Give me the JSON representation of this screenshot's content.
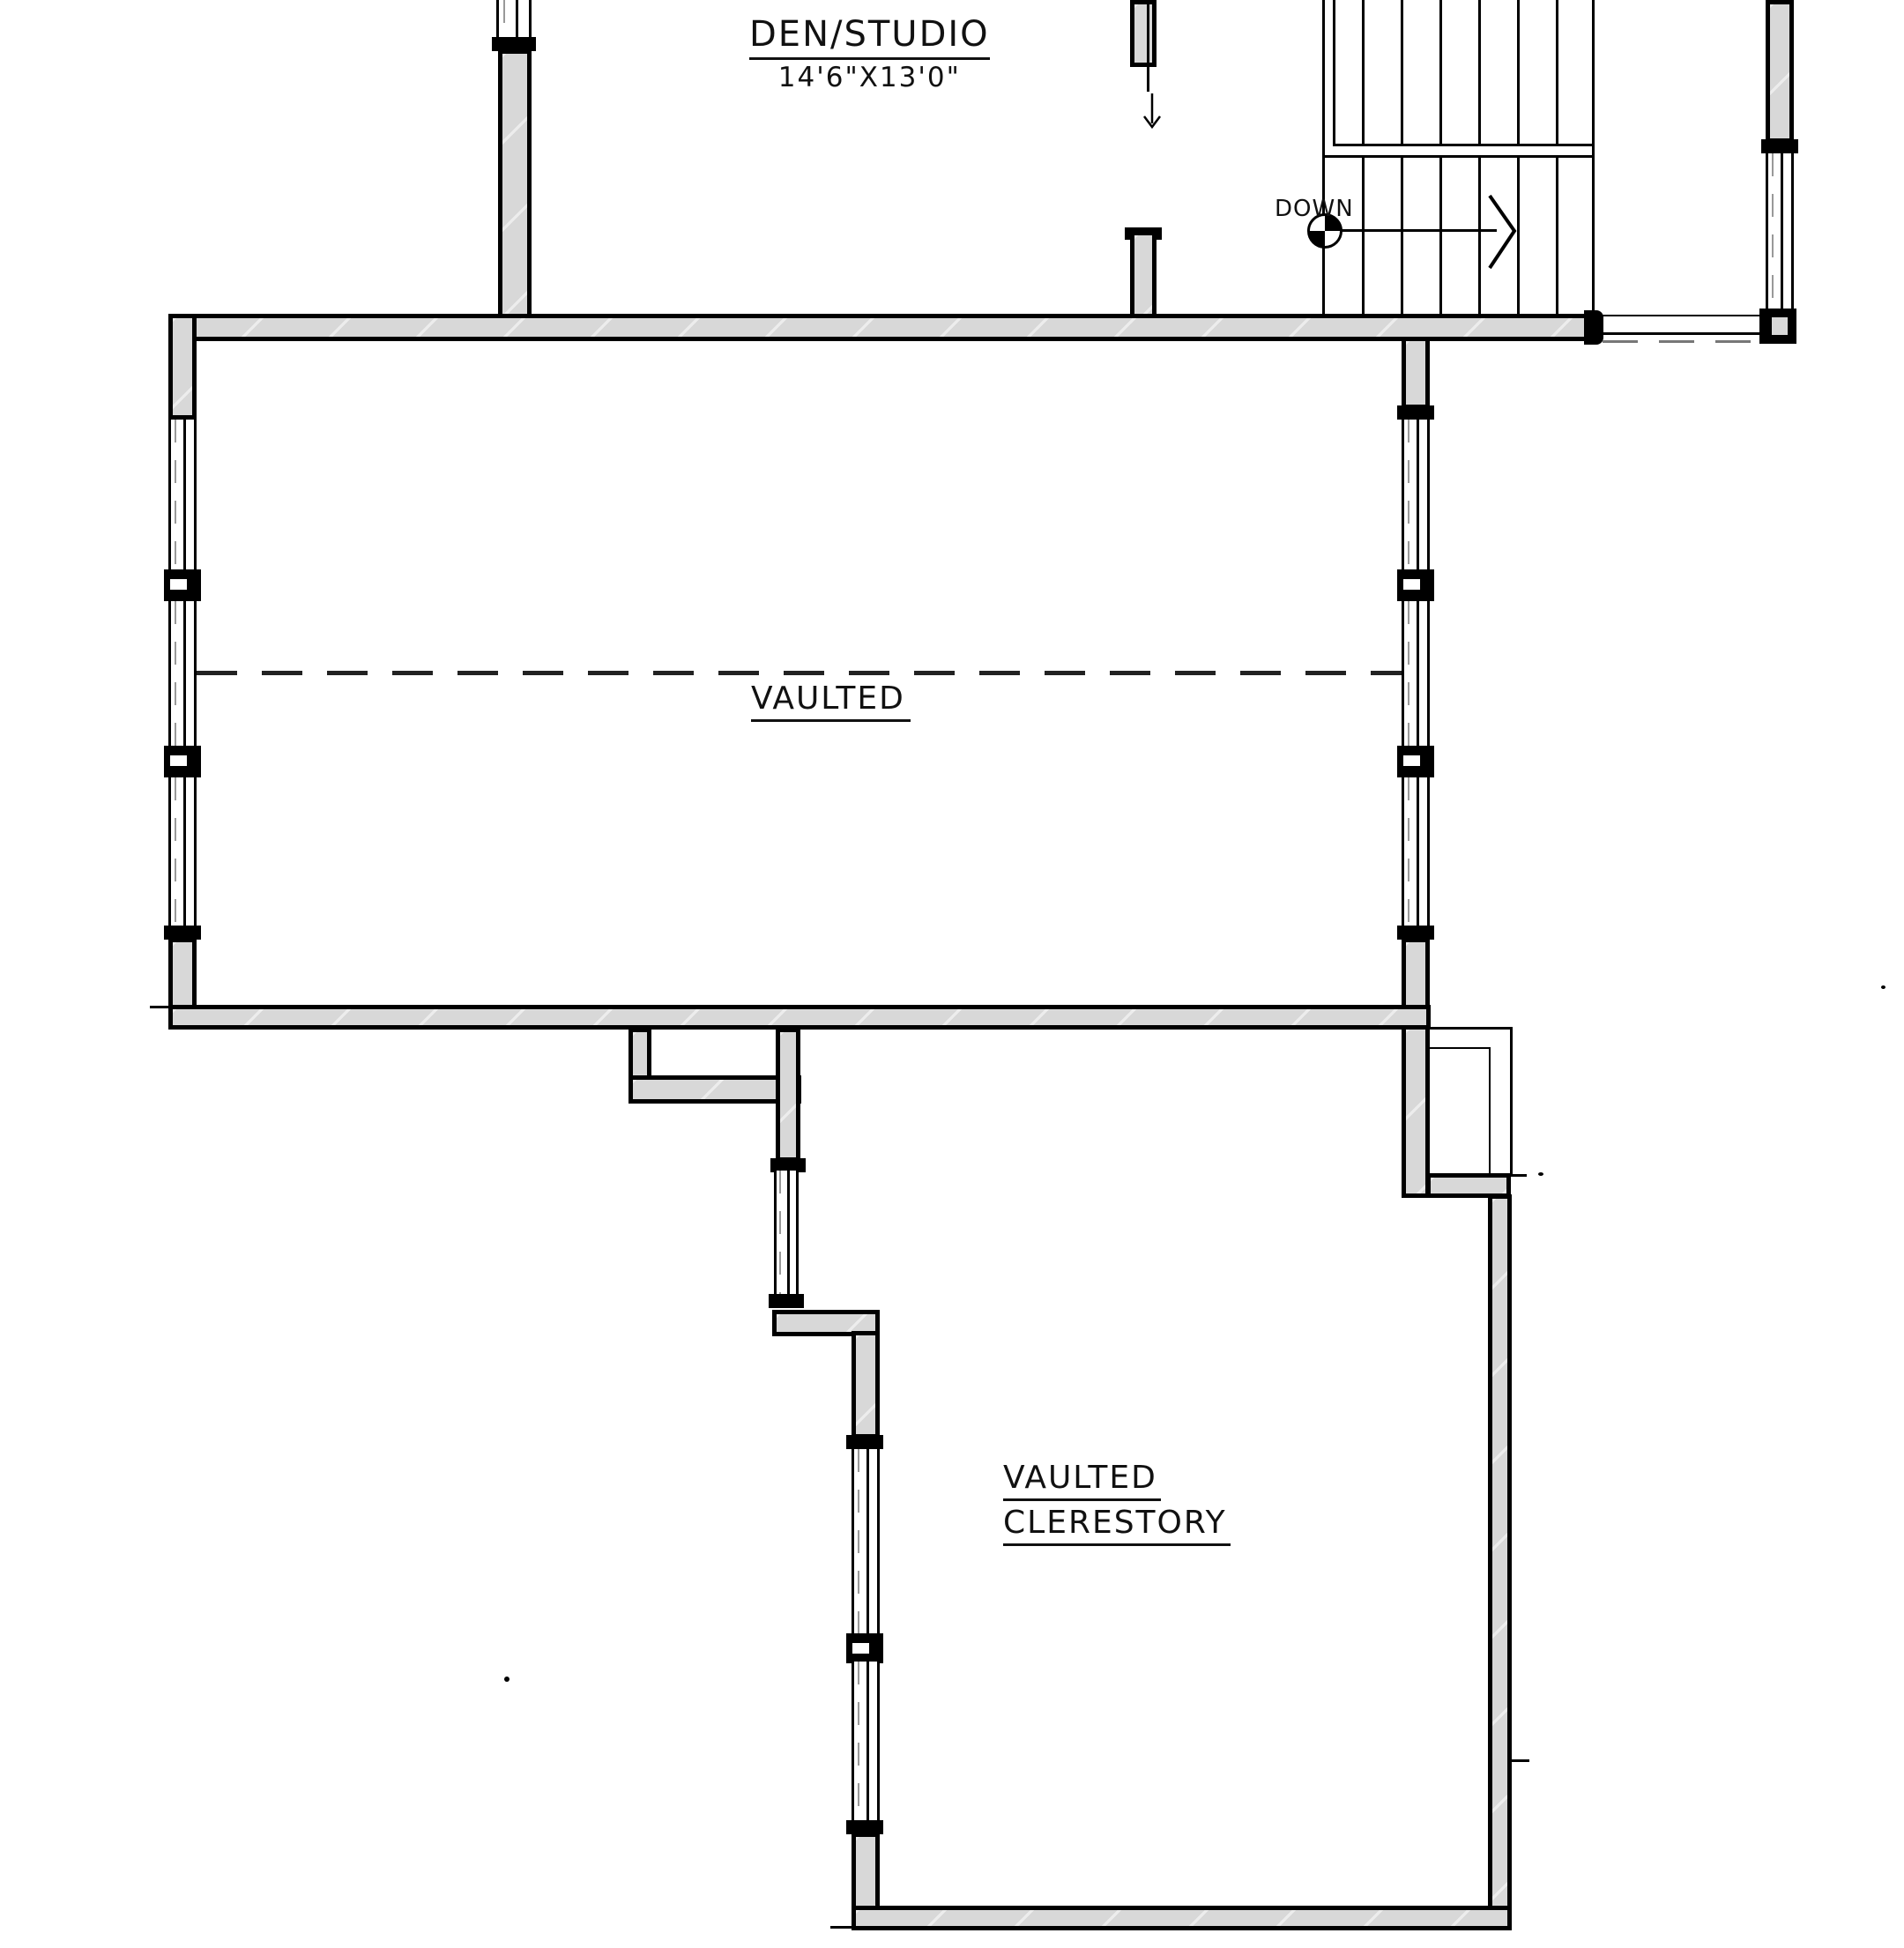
{
  "labels": {
    "den_studio": {
      "name": "DEN/STUDIO",
      "dims": "14'6\"X13'0\""
    },
    "stair": {
      "down": "DOWN"
    },
    "vaulted_room": {
      "label": "VAULTED"
    },
    "clerestory_room": {
      "line1": "VAULTED",
      "line2": "CLERESTORY"
    }
  },
  "colors": {
    "wall_fill": "#d8d8d8",
    "line": "#000000",
    "window_dash": "#999999",
    "vault_dash": "#222222"
  }
}
